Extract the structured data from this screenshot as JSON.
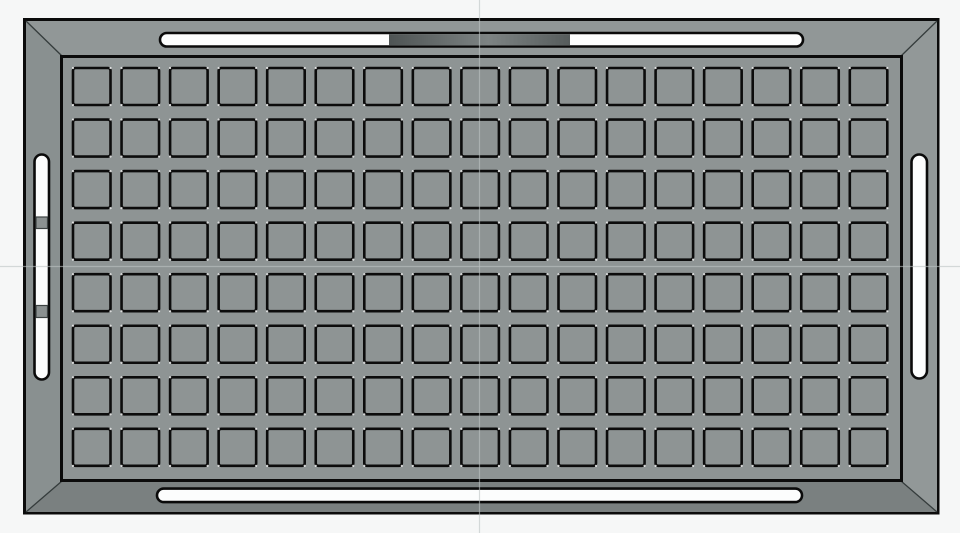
{
  "viewport": {
    "width": 960,
    "height": 533,
    "background": "#f6f7f7",
    "axis": {
      "color": "rgba(188,195,195,0.6)",
      "stroke_width": 1.2,
      "vertical": {
        "x1": 479.5,
        "y1": 0,
        "x2": 479.5,
        "y2": 533
      },
      "horizontal": {
        "x1": 0,
        "y1": 266.5,
        "x2": 960,
        "y2": 266.5
      }
    }
  },
  "model": {
    "outline_color": "#0b0b0b",
    "outer": {
      "x": 24.5,
      "y": 19.5,
      "w": 913.5,
      "h": 493.5,
      "fill": "#8d9393",
      "stroke": "#0b0b0b",
      "stroke_width": 3
    },
    "faces": {
      "top": {
        "points": "26,21 937,21 901,56 62,56",
        "fill": "#919797"
      },
      "bottom": {
        "points": "62,481 901,481 937,512 26,512",
        "fill": "#7a8080"
      },
      "left": {
        "points": "26,21 62,56 62,481 26,512",
        "fill": "#899090"
      },
      "right": {
        "points": "937,21 901,56 901,481 937,512",
        "fill": "#929898"
      }
    },
    "miters": {
      "color": "#353c3c",
      "stroke_width": 1.3,
      "tl": {
        "x1": 26,
        "y1": 21,
        "x2": 62,
        "y2": 56
      },
      "tr": {
        "x1": 937,
        "y1": 21,
        "x2": 901,
        "y2": 56
      },
      "bl": {
        "x1": 26,
        "y1": 512,
        "x2": 62,
        "y2": 481
      },
      "br": {
        "x1": 937,
        "y1": 512,
        "x2": 901,
        "y2": 481
      }
    },
    "plate": {
      "x": 61.5,
      "y": 56.5,
      "w": 840,
      "h": 424,
      "fill": "#8e9494",
      "stroke": "#0b0b0b",
      "stroke_width": 3
    },
    "grid": {
      "rows": 8,
      "cols": 17,
      "x0": 73,
      "y0": 68,
      "cell_w": 37.5,
      "cell_h": 37,
      "pitch_x": 48.55,
      "pitch_y": 51.55,
      "corner_radius": 2.5,
      "fill": "#8e9494",
      "stroke": "#0c0c0c",
      "stroke_width": 2.6,
      "corner_dot_radius": 1.1,
      "corner_dot_color": "rgba(255,255,255,0.8)"
    },
    "slots": {
      "fill": "#fcfdfd",
      "stroke": "#0a0a0a",
      "stroke_width": 2.6,
      "top": {
        "x": 160,
        "y": 33,
        "w": 643,
        "h": 13.5,
        "rx": 6.7
      },
      "bottom": {
        "x": 157,
        "y": 488.6,
        "w": 645,
        "h": 13.5,
        "rx": 6.7
      },
      "left": {
        "x": 34.5,
        "y": 154.5,
        "w": 14.5,
        "h": 225,
        "rx": 7.2
      },
      "right": {
        "x": 911.5,
        "y": 154.5,
        "w": 15.5,
        "h": 224,
        "rx": 7.7
      }
    },
    "dark_segment": {
      "x": 389,
      "y": 34.2,
      "w": 181,
      "h": 11.1,
      "color_left": "#4e5454",
      "color_mid": "#7d8383",
      "color_right": "#565c5c"
    },
    "left_slot_tabs": {
      "fill": "#8b9191",
      "stroke": "#3c4242",
      "stroke_width": 1.2,
      "tab1": {
        "x": 36,
        "y": 217,
        "w": 11.5,
        "h": 11.5
      },
      "tab2": {
        "x": 36,
        "y": 305.5,
        "w": 11.5,
        "h": 12
      }
    }
  }
}
